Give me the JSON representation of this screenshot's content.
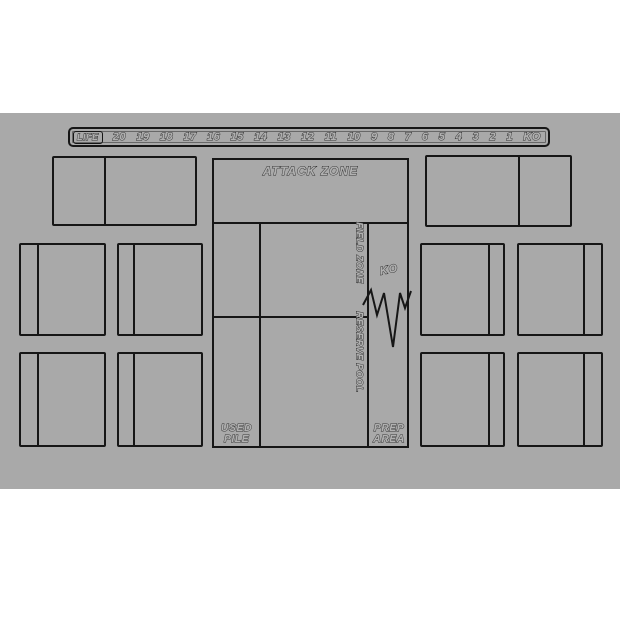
{
  "colors": {
    "mat": "#a9a9a9",
    "line": "#161616",
    "page_background": "#ffffff",
    "letter_fill": "#b1b1b1"
  },
  "life_track": {
    "label": "LIFE",
    "values": [
      "20",
      "19",
      "18",
      "17",
      "16",
      "15",
      "14",
      "13",
      "12",
      "11",
      "10",
      "9",
      "8",
      "7",
      "6",
      "5",
      "4",
      "3",
      "2",
      "1",
      "KO"
    ]
  },
  "board": {
    "attack_zone_label": "ATTACK ZONE",
    "field_zone_label": "FIELD ZONE",
    "reserve_pool_label": "RESERVE POOL",
    "ko_label": "KO",
    "used_pile": {
      "line1": "USED",
      "line2": "PILE"
    },
    "prep_area": {
      "line1": "PREP",
      "line2": "AREA"
    }
  }
}
